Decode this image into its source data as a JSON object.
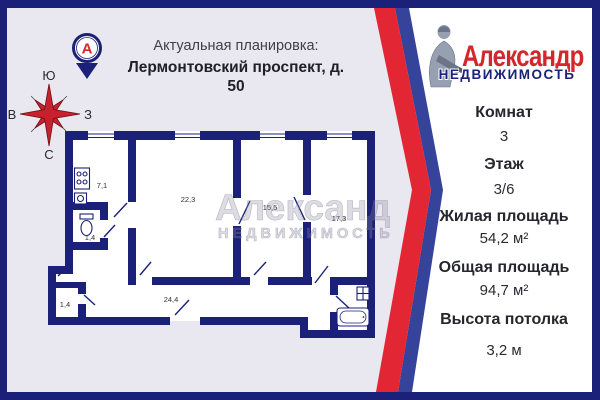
{
  "colors": {
    "navy": "#1b2178",
    "stripe_red": "#e32633",
    "stripe_blue": "#35439a",
    "background": "#e9e7f0",
    "card": "#ffffff",
    "brand_red": "#d5262c"
  },
  "header": {
    "pin_letter": "А",
    "title_line1": "Актуальная планировка:",
    "title_line2": "Лермонтовский проспект, д. 50"
  },
  "compass": {
    "top": "Ю",
    "left": "В",
    "right": "З",
    "bottom": "С"
  },
  "floor_plan": {
    "watermark": {
      "line1": "Александр",
      "line2": "НЕДВИЖИМОСТЬ"
    },
    "rooms": {
      "kitchen": "7,1",
      "wc": "1,4",
      "living_room": "22,3",
      "bedroom": "15,5",
      "bedroom2": "17,3",
      "storage": "1,4",
      "corridor": "24,4"
    }
  },
  "brand": {
    "name": "Александр",
    "subtitle": "НЕДВИЖИМОСТЬ"
  },
  "details": [
    {
      "label": "Комнат",
      "value": "3"
    },
    {
      "label": "Этаж",
      "value": "3/6"
    },
    {
      "label": "Жилая площадь",
      "value": "54,2 м²"
    },
    {
      "label": "Общая площадь",
      "value": "94,7 м²"
    },
    {
      "label": "Высота потолка",
      "value": "3,2 м"
    }
  ]
}
